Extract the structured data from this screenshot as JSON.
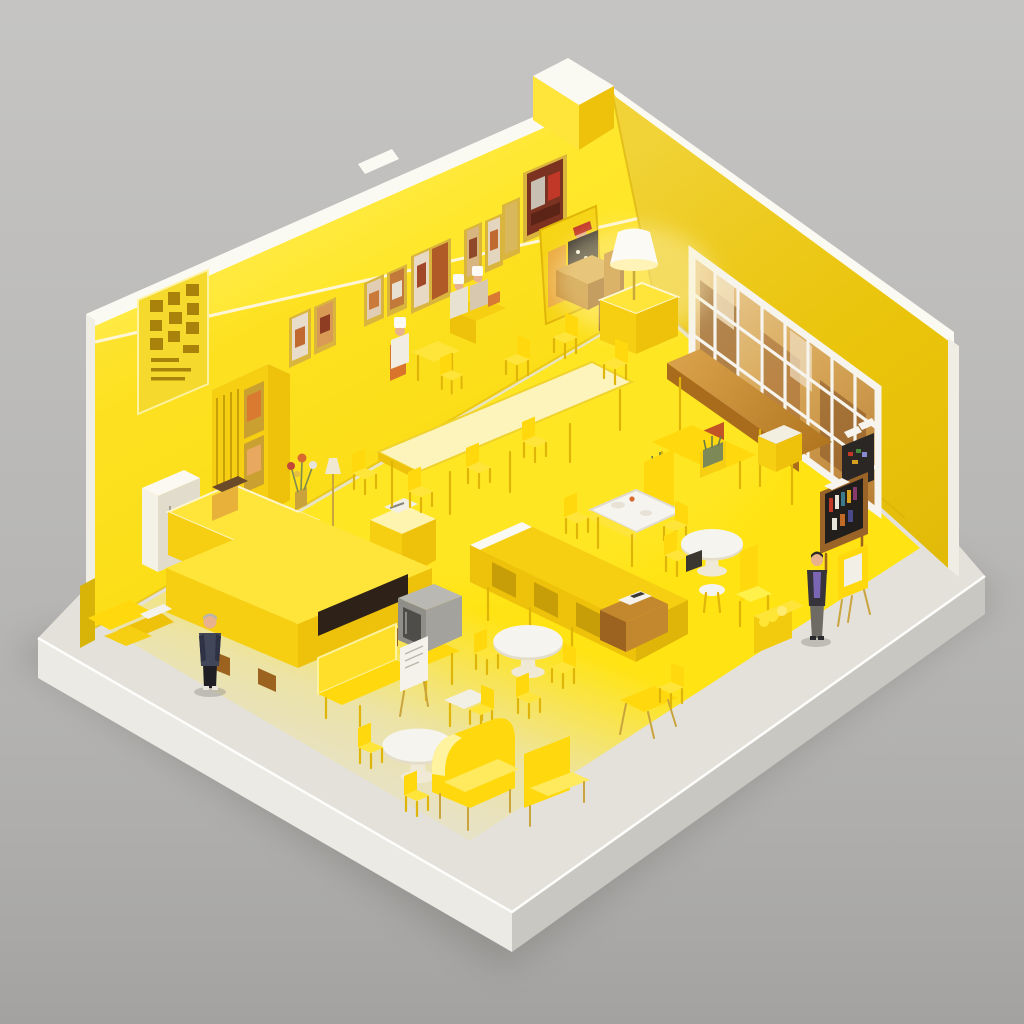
{
  "scene": {
    "type": "3d-isometric-render",
    "subject": "Miniature diorama of a monochrome yellow cafe-canteen interior built on a white base slab",
    "style": "soft studio light, vivid yellow palette that fades to pale gray at the open front edge, neutral gray backdrop",
    "camera": "elevated three-quarter isometric view from the front-left"
  },
  "colors": {
    "background": "#b5b4b2",
    "platform_top": "#e3e1da",
    "platform_front": "#eceae5",
    "platform_side": "#c9c7c1",
    "floor": "#ffe312",
    "wall_left": "#ffe519",
    "wall_right": "#eec90c",
    "wall_trim": "#fbfaf2",
    "wood": "#c3872e",
    "white_surface": "#f6f4ee",
    "chair_yellow": "#ffd90e",
    "chair_highlight": "#ffe53a",
    "dark_accent": "#2e2a26",
    "hearth_dark": "#2e2218",
    "tv_gray": "#8f8e89",
    "lamp_white": "#fbfaf4",
    "frame_gold": "#d9b53e",
    "plant_green": "#7d8a58",
    "skin": "#e7b28d",
    "outfit_navy": "#414659",
    "outfit_purple": "#7b66b4"
  },
  "room": {
    "left_wall_features": [
      "carved lattice sign panel with glyphs",
      "row of gold-framed pictures with warm artwork",
      "mid-height ledge step",
      "white top trim",
      "chimney block at the top corner"
    ],
    "right_wall_features": [
      "large white-grid window with warm scenes behind",
      "white top trim",
      "wide end pillar"
    ],
    "window_grid": {
      "columns": 8,
      "rows": 3
    },
    "picture_frame_count": 9
  },
  "furniture": [
    {
      "name": "tall-slatted-cabinet",
      "where": "against left wall",
      "detail": "vent slats and shelf boxes"
    },
    {
      "name": "small-white-cabinet",
      "where": "left wall base"
    },
    {
      "name": "service-counter",
      "where": "upper left",
      "detail": "cash register and flower vase"
    },
    {
      "name": "podium-stand",
      "where": "left of center",
      "detail": "white device on top"
    },
    {
      "name": "fireplace-counter",
      "where": "front left",
      "detail": "long yellow block with dark hearth slot and wood feet"
    },
    {
      "name": "wall-desk-with-chef",
      "where": "along back-left wall",
      "count": 2
    },
    {
      "name": "corner-booth-desk",
      "where": "wall corner",
      "detail": "wooden desk, seated figure with red cap"
    },
    {
      "name": "sideboard-cabinet",
      "where": "right wall corner"
    },
    {
      "name": "floor-lamp",
      "where": "on sideboard",
      "detail": "white shade, warm glow"
    },
    {
      "name": "wooden-window-table",
      "where": "under grid window",
      "detail": "plank top, yellow legs, bench, red cabinet, two planters"
    },
    {
      "name": "service-cart",
      "where": "right of window table"
    },
    {
      "name": "communal-table",
      "where": "center",
      "detail": "long pale-top table with seven yellow chairs"
    },
    {
      "name": "bar-counter",
      "where": "center front",
      "detail": "white-edged top, open panel legs, wooden till with device"
    },
    {
      "name": "crt-tv-on-stand",
      "where": "center front-left"
    },
    {
      "name": "white-top-dining-table",
      "where": "center right",
      "detail": "dishes and cup, high-back bench"
    },
    {
      "name": "round-dining-table",
      "count": 3,
      "where": "center and front",
      "detail": "white tops, yellow pedestals and chairs"
    },
    {
      "name": "wingback-armchair",
      "count": 2,
      "where": "front center"
    },
    {
      "name": "loveseat-with-sign-table",
      "where": "front left",
      "detail": "white sign panel"
    },
    {
      "name": "folding-desk-and-chair",
      "where": "front right of center"
    },
    {
      "name": "cushion-high-chair",
      "where": "right, near round table"
    },
    {
      "name": "magazine-rack",
      "where": "right wall",
      "detail": "wood frame, dark shelves with colorful spines, white sheets on top"
    },
    {
      "name": "arcade-stand",
      "where": "right wall",
      "detail": "dark cabinet with pixel screen and two white signs"
    },
    {
      "name": "folding-chair-easel",
      "where": "beside right man",
      "detail": "white panel"
    },
    {
      "name": "yellow-crate",
      "where": "front right",
      "detail": "filled with yellow cloth"
    },
    {
      "name": "scattered-planks",
      "where": "front-left platform corner"
    }
  ],
  "people": [
    {
      "name": "standing-man-left",
      "outfit": "dark navy sweater, black trousers, gray hair",
      "where": "front-left open platform"
    },
    {
      "name": "standing-man-right",
      "outfit": "dark jacket over purple shirt, gray trousers",
      "where": "front-right near wall end"
    },
    {
      "name": "seated-chef",
      "outfit": "white chef hat",
      "where": "desk along back-left wall"
    },
    {
      "name": "seated-pair",
      "outfit": "white hats",
      "where": "desk near wall corner"
    },
    {
      "name": "seated-figure-red-cap",
      "outfit": "dark coat, red cap",
      "where": "corner booth"
    }
  ]
}
